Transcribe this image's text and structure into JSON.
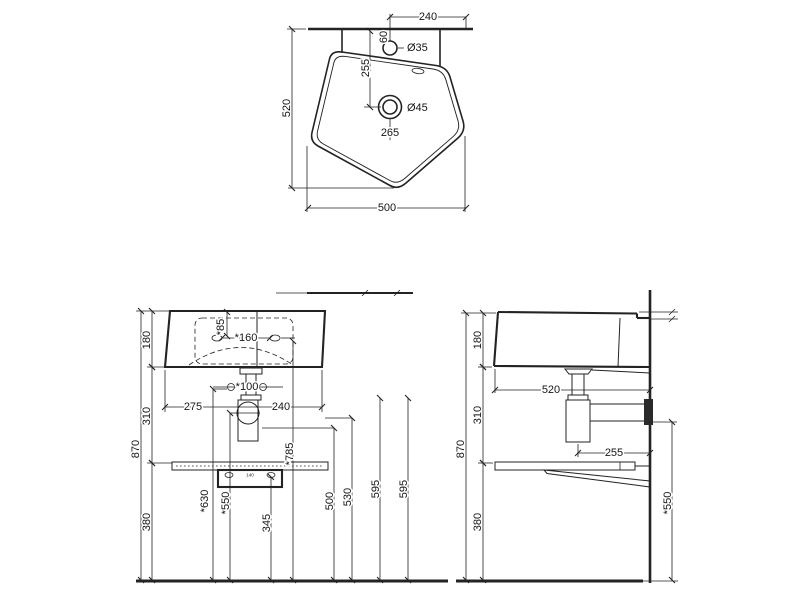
{
  "drawing_type": "sink-technical-drawing",
  "colors": {
    "line": "#232323",
    "background": "#ffffff"
  },
  "dims": {
    "top": {
      "d240": "240",
      "hole_small": "Ø35",
      "d60": "60",
      "d255": "255",
      "d520": "520",
      "hole_big": "Ø45",
      "d265": "265",
      "d500": "500"
    },
    "front": {
      "d180": "180",
      "d85": "*85",
      "d160": "*160",
      "d100": "*100",
      "d275": "275",
      "d240": "240",
      "d310": "310",
      "d870": "870",
      "d785": "*785",
      "d140": "140",
      "d630": "*630",
      "d550": "*550",
      "d345": "345",
      "d380": "380",
      "d500": "500",
      "d530": "530",
      "d595a": "595",
      "d595b": "595"
    },
    "side": {
      "d180": "180",
      "d520": "520",
      "d310": "310",
      "d870": "870",
      "d255": "255",
      "d380": "380",
      "d550": "*550"
    }
  }
}
